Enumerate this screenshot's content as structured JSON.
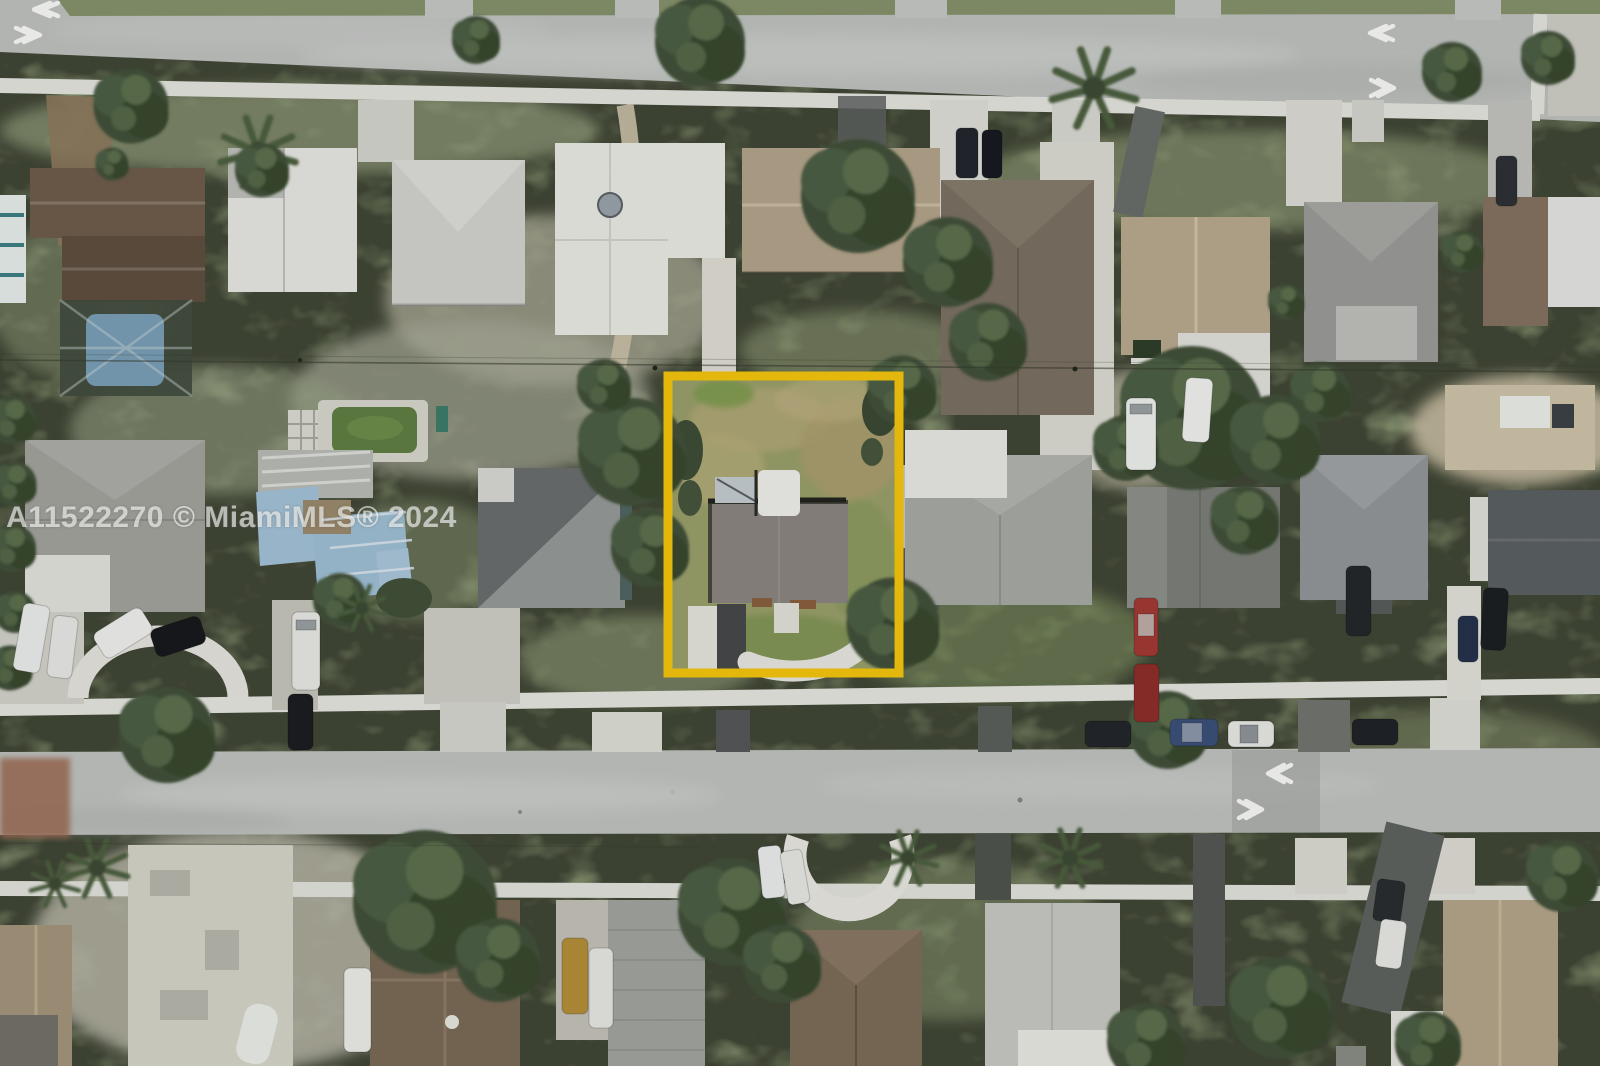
{
  "watermark": {
    "text": "A11522270 © MiamiMLS® 2024"
  },
  "highlight": {
    "color": "#F6C60D",
    "meaning": "property-boundary-outline"
  },
  "scene": {
    "type": "aerial-neighborhood-photo",
    "pool_water_color": "#5f7f42",
    "screened_pool_color": "#7aa0b8",
    "tarp_roof_color": "#a4c2d8"
  },
  "road_markings": {
    "chevrons": [
      {
        "direction": "left",
        "location": "top-left-road"
      },
      {
        "direction": "right",
        "location": "top-left-road"
      },
      {
        "direction": "left",
        "location": "top-right-road"
      },
      {
        "direction": "right",
        "location": "top-right-road"
      },
      {
        "direction": "left",
        "location": "middle-road"
      },
      {
        "direction": "right",
        "location": "middle-road"
      }
    ]
  }
}
